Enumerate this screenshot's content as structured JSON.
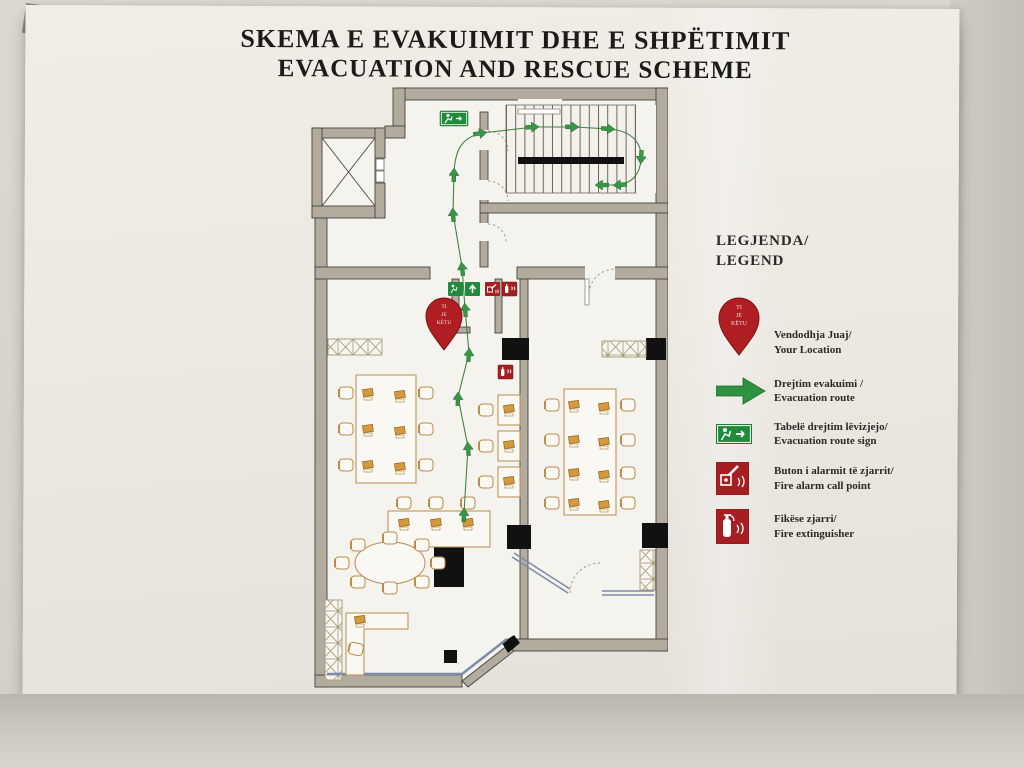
{
  "title": {
    "line1": "SKEMA E EVAKUIMIT DHE E SHPËTIMIT",
    "line2": "EVACUATION AND RESCUE SCHEME"
  },
  "legend": {
    "heading_line1": "LEGJENDA/",
    "heading_line2": "LEGEND",
    "items": [
      {
        "id": "your-location",
        "label_sq": "Vendodhja Juaj/",
        "label_en": "Your Location"
      },
      {
        "id": "evacuation-route",
        "label_sq": "Drejtim evakuimi /",
        "label_en": "Evacuation route"
      },
      {
        "id": "evacuation-route-sign",
        "label_sq": "Tabelë  drejtim lëvizjejo/",
        "label_en": "Evacuation route sign"
      },
      {
        "id": "fire-alarm-call-point",
        "label_sq": "Buton i alarmit të zjarrit/",
        "label_en": "Fire alarm call point"
      },
      {
        "id": "fire-extinguisher",
        "label_sq": "Fikëse zjarri/",
        "label_en": "Fire extinguisher"
      }
    ]
  },
  "floor_plan": {
    "you_are_here_pin": {
      "line1": "TI",
      "line2": "JE",
      "line3": "KËTU"
    },
    "rooms": [
      "elevator",
      "stairwell",
      "upper-hall",
      "open-office-left",
      "open-office-right",
      "meeting-room",
      "corridor"
    ],
    "symbol_counts": {
      "exit_signs": 2,
      "route_direction_arrows": 13,
      "fire_alarm_call_points": 1,
      "fire_extinguishers": 3,
      "you_are_here_pins": 1
    }
  },
  "colors": {
    "route_green": "#2f9240",
    "sign_red": "#a41e22",
    "wall_tan": "#b3ac9e",
    "glass_blue": "#7d8cab",
    "poster_cream": "#ece9e2"
  }
}
